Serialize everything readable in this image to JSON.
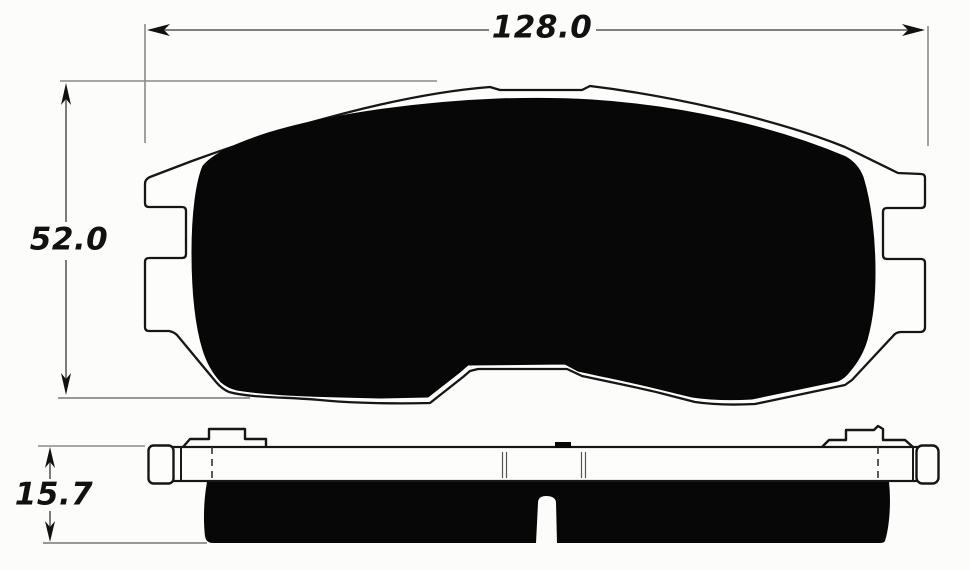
{
  "canvas": {
    "background": "#fcfcfb"
  },
  "drawing": {
    "description": "brake pad dimensional drawing, front view and side view",
    "dimensions": {
      "width": {
        "label": "128.0"
      },
      "height": {
        "label": "52.0"
      },
      "thickness": {
        "label": "15.7"
      }
    },
    "colors": {
      "outline": "#161616",
      "pad_fill": "#070707",
      "dimension_line": "#6e6e6e",
      "extension_line": "#8a8a8a",
      "label_text": "#111111"
    }
  }
}
